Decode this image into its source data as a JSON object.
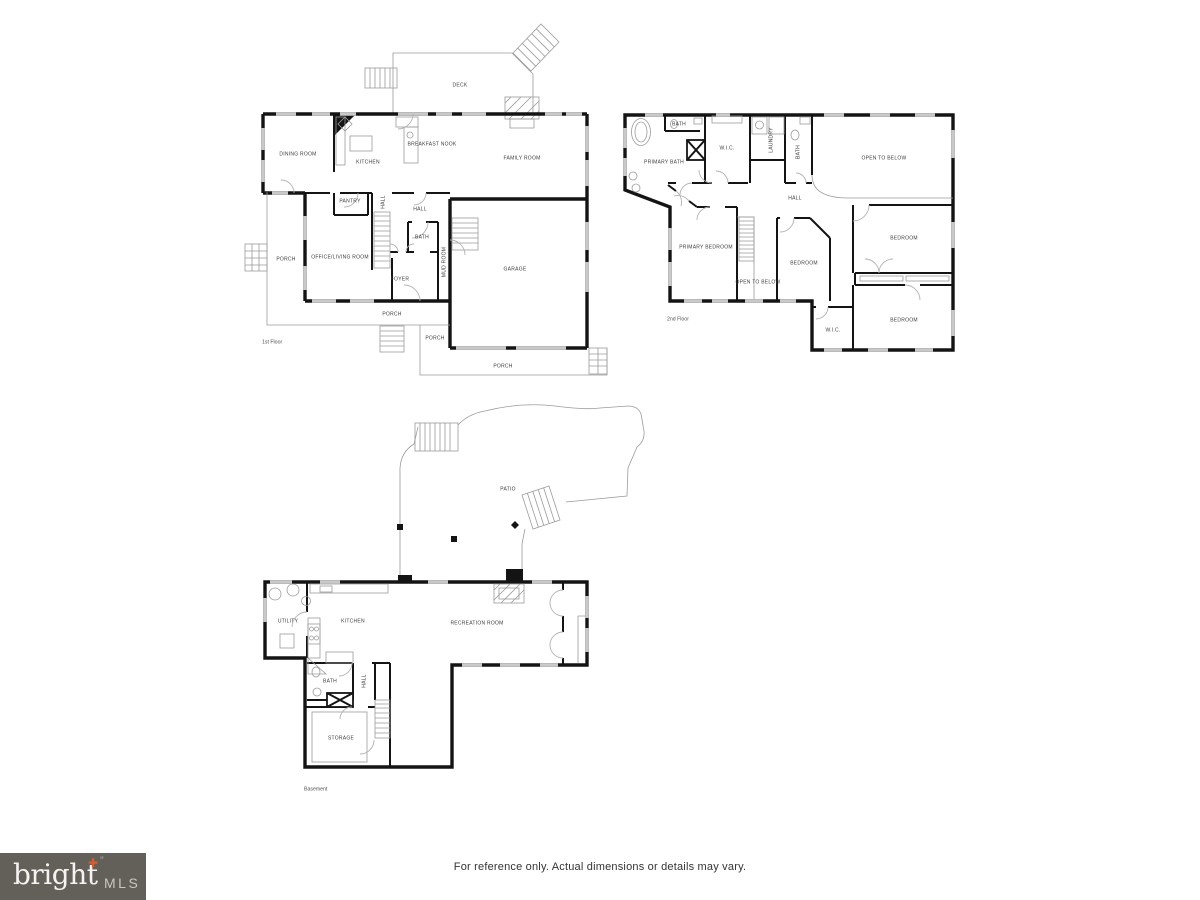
{
  "footer": {
    "disclaimer": "For reference only. Actual dimensions or details may vary."
  },
  "brand": {
    "word": "bright",
    "suffix": "MLS",
    "accent": "✚",
    "quote": "”",
    "accent_color": "#e0592a",
    "box_color": "#636059"
  },
  "colors": {
    "wall": "#141414",
    "window": "#c9c9c9",
    "thin_line": "#9b9b9b",
    "label": "#3c3c3c"
  },
  "floors": {
    "first": {
      "name": "1st Floor",
      "rooms": {
        "deck": "DECK",
        "dining": "DINING ROOM",
        "kitchen": "KITCHEN",
        "breakfast": "BREAKFAST NOOK",
        "family": "FAMILY ROOM",
        "pantry": "PANTRY",
        "hall_stairs": "HALL",
        "hall": "HALL",
        "bath": "BATH",
        "mud": "MUD ROOM",
        "foyer": "FOYER",
        "office": "OFFICE/LIVING ROOM",
        "garage": "GARAGE",
        "porch_left": "PORCH",
        "porch_bottom": "PORCH",
        "porch_small": "PORCH",
        "porch_rear": "PORCH"
      }
    },
    "second": {
      "name": "2nd Floor",
      "rooms": {
        "primary_bath": "PRIMARY BATH",
        "bath_a": "BATH",
        "wic_a": "W.I.C.",
        "laundry": "LAUNDRY",
        "bath_b": "BATH",
        "open_below_a": "OPEN TO BELOW",
        "hall": "HALL",
        "primary_bedroom": "PRIMARY BEDROOM",
        "bedroom_a": "BEDROOM",
        "bedroom_b": "BEDROOM",
        "open_below_b": "OPEN TO BELOW",
        "wic_b": "W.I.C.",
        "bedroom_c": "BEDROOM"
      }
    },
    "basement": {
      "name": "Basement",
      "rooms": {
        "patio": "PATIO",
        "utility": "UTILITY",
        "kitchen": "KITCHEN",
        "recreation": "RECREATION ROOM",
        "bath": "BATH",
        "hall": "HALL",
        "storage": "STORAGE"
      }
    }
  }
}
